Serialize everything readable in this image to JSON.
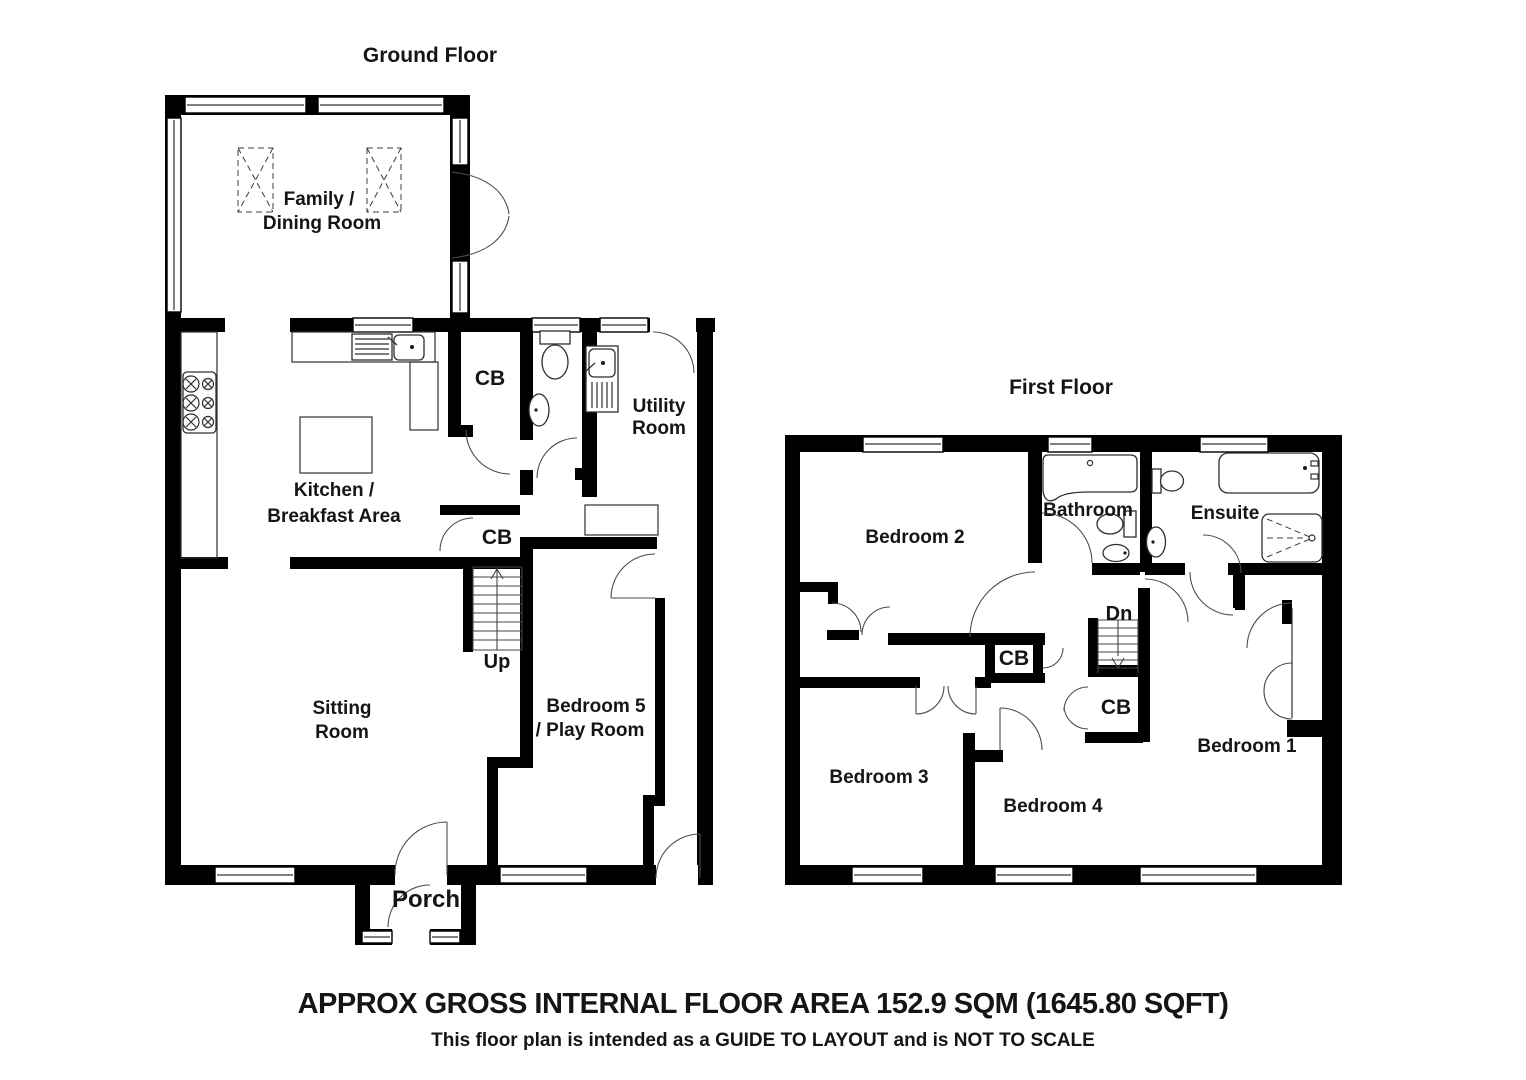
{
  "document": {
    "type": "floor-plan",
    "background": "#ffffff"
  },
  "colors": {
    "wall": "#000000",
    "background": "#ffffff",
    "fixture_line": "#2e2e2e",
    "door_arc": "#4d4d4d",
    "text": "#151515"
  },
  "ground_floor": {
    "title": "Ground Floor",
    "rooms": {
      "family_dining": {
        "line1": "Family /",
        "line2": "Dining Room"
      },
      "kitchen": {
        "line1": "Kitchen /",
        "line2": "Breakfast Area"
      },
      "utility": {
        "line1": "Utility",
        "line2": "Room"
      },
      "sitting": {
        "line1": "Sitting",
        "line2": "Room"
      },
      "bedroom5": {
        "line1": "Bedroom 5",
        "line2": "/ Play Room"
      },
      "porch": {
        "label": "Porch"
      },
      "cupboard_top": {
        "label": "CB"
      },
      "cupboard_hall": {
        "label": "CB"
      }
    },
    "stairs": {
      "label": "Up"
    },
    "fixtures": [
      "hob",
      "sink-drainer",
      "kitchen-island",
      "wc-toilet",
      "wc-basin",
      "utility-sink",
      "worktop",
      "roof-lantern",
      "roof-lantern"
    ]
  },
  "first_floor": {
    "title": "First Floor",
    "rooms": {
      "bedroom1": {
        "label": "Bedroom 1"
      },
      "bedroom2": {
        "label": "Bedroom 2"
      },
      "bedroom3": {
        "label": "Bedroom 3"
      },
      "bedroom4": {
        "label": "Bedroom 4"
      },
      "bathroom": {
        "label": "Bathroom"
      },
      "ensuite": {
        "label": "Ensuite"
      },
      "cupboard_landing": {
        "label": "CB"
      },
      "cupboard_under_stairs": {
        "label": "CB"
      }
    },
    "stairs": {
      "label": "Dn"
    },
    "fixtures": [
      "p-shaped-bath",
      "toilet",
      "basin",
      "straight-bath",
      "toilet",
      "basin",
      "shower"
    ]
  },
  "footer": {
    "area_line": "APPROX GROSS INTERNAL FLOOR AREA  152.9 SQM (1645.80  SQFT)",
    "disclaimer": "This floor plan is intended as a GUIDE TO LAYOUT and is NOT TO SCALE"
  }
}
